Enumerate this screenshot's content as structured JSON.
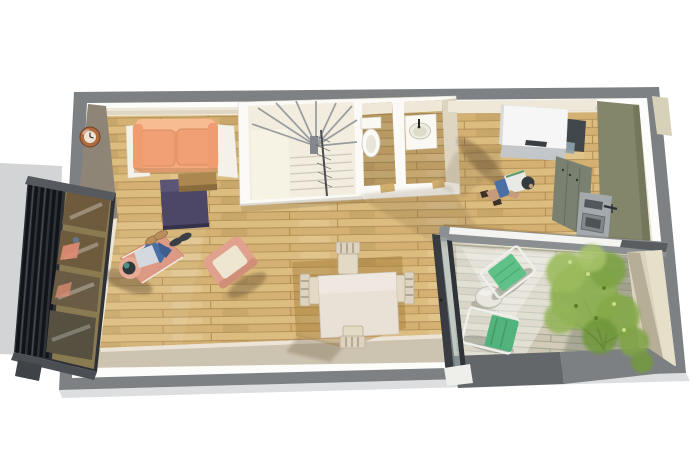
{
  "scene": {
    "type": "3d-floor-plan-top-view-render",
    "objects": [
      "sofa",
      "wall-clock",
      "rug",
      "coffee-table",
      "chaise-longue",
      "reclining-person",
      "armchair",
      "dining-table",
      "dining-chairs",
      "spiral-staircase",
      "stair-railing",
      "toilet",
      "washbasin-vanity",
      "kitchen-counter",
      "refrigerator-cabinet",
      "kitchen-wall-panel",
      "kitchen-sink-unit",
      "standing-person",
      "half-wall",
      "sliding-glass-door",
      "terrace-deck",
      "deck-chairs",
      "bistro-table",
      "tree",
      "gravel-strip",
      "louvered-window-wall",
      "flip-flops"
    ],
    "colors": {
      "background": "#ffffff",
      "ground_gray": "#d2d4d6",
      "outer_wall": "#7e8183",
      "inner_band": "#fcfcfb",
      "interior_base": "#ece5d4",
      "wood_floor": "#d9b878",
      "deck_wood": "#ccc6b3",
      "south_wall_face": "#cdc3b1",
      "taupe_wall": "#8e8577",
      "cream_wall": "#efe8d8",
      "stair_floor": "#f2edde",
      "sofa_salmon": "#f3a77c",
      "armchair_salmon": "#e0a18e",
      "chaise_salmon": "#dc9a84",
      "cushion_cream": "#efe6d1",
      "rug_navy": "#4d4767",
      "coffee_table_brown": "#ab8850",
      "clock_copper": "#b06a40",
      "kitchen_olive": "#83866b",
      "cabinet_olive": "#7b8170",
      "counter_dark": "#41464b",
      "appliance_steel": "#a3a9ac",
      "fixture_white": "#f9f8f2",
      "half_wall_gray": "#8b8f91",
      "parapet_dark": "#64676a",
      "glass_frame_dark": "#2e3237",
      "glass_bronze": "#6e5a3c",
      "door_frame": "#383c41",
      "deck_chair_green": "#5fc188",
      "deck_chair_green2": "#52b37c",
      "chair_frame_white": "#eff0ec",
      "tree_green": "#8db052",
      "tree_trunk": "#433b2b",
      "gravel_beige": "#dbd3bd",
      "dining_table_top": "#e9e1d6",
      "dining_chair": "#e3dac6",
      "person_shirt": "#e9e9e5",
      "person_shorts": "#4a6fa5",
      "person_skin": "#c59b79",
      "shadow_brown": "#6e5a3a"
    }
  }
}
